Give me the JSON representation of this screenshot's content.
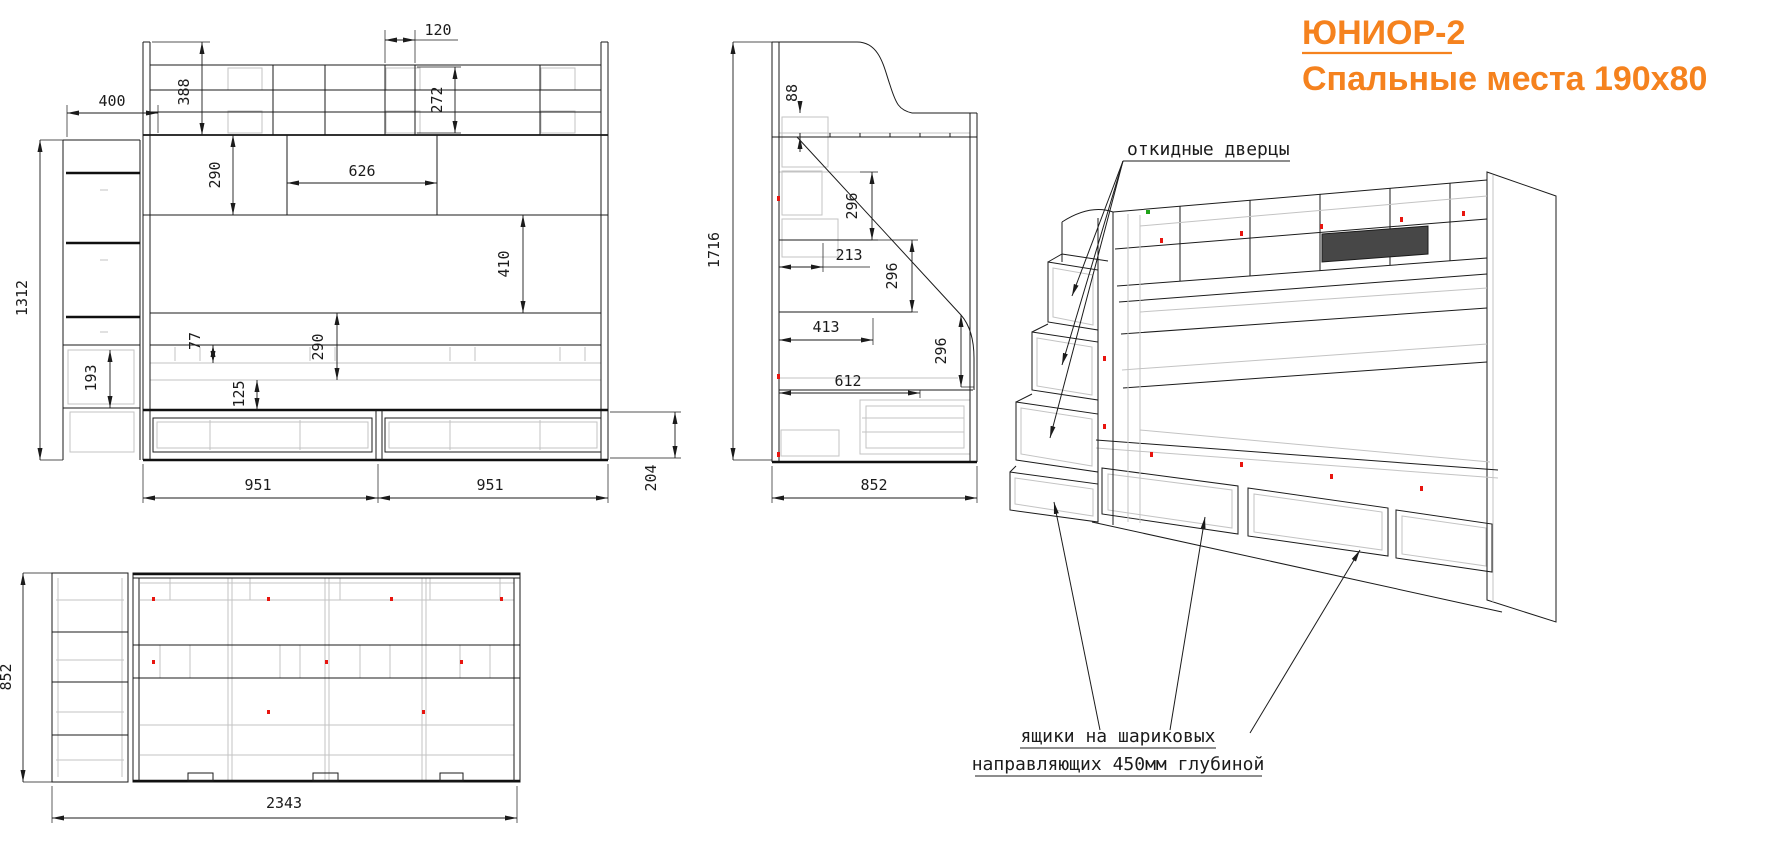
{
  "title": {
    "line1": "ЮНИОР-2",
    "line2": "Спальные места 190x80"
  },
  "colors": {
    "accent": "#F5821E",
    "line": "#1B1B1B",
    "light_gray": "#C3C3C3",
    "mark_red": "#E8150F",
    "mark_green": "#1FA318"
  },
  "annotations": {
    "flip_doors": "откидные дверцы",
    "drawers_line1": "ящики на шариковых",
    "drawers_line2": "направляющих 450мм глубиной"
  },
  "front_view": {
    "dims": {
      "d120": "120",
      "d388": "388",
      "d272": "272",
      "d400": "400",
      "d626": "626",
      "d290_shelf": "290",
      "d410": "410",
      "d1312": "1312",
      "d193": "193",
      "d77": "77",
      "d290_rail": "290",
      "d125": "125",
      "d951_left": "951",
      "d951_right": "951",
      "d204": "204"
    }
  },
  "side_view": {
    "dims": {
      "d88": "88",
      "d1716": "1716",
      "d296_top": "296",
      "d213": "213",
      "d296_mid": "296",
      "d413": "413",
      "d296_bot": "296",
      "d612": "612",
      "d852": "852"
    }
  },
  "top_view": {
    "dims": {
      "d852": "852",
      "d2343": "2343"
    }
  }
}
